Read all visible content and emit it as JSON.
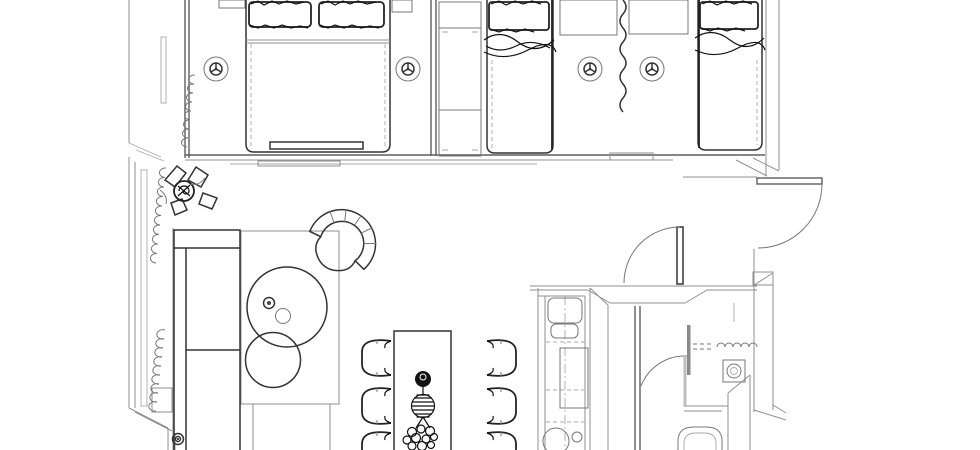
{
  "floor_plan": {
    "background": "#ffffff",
    "line_color": "#333333",
    "wall_color": "#8f8f8f",
    "accent_dark": "#111111",
    "rooms": [
      {
        "name": "master-bedroom",
        "aria": "Master bedroom: double bed with two pillows, two nightstands, foot bench, window curtain, sprinkler heads"
      },
      {
        "name": "second-bedroom",
        "aria": "Second bedroom: two single beds, wardrobe, two nightstands, curtain room divider, two sprinkler heads"
      },
      {
        "name": "living-room",
        "aria": "Living room: sofa, rug, two round coffee tables, curved armchair, potted plant, window curtains"
      },
      {
        "name": "dining-area",
        "aria": "Dining area: long table with six chairs and flower centerpiece"
      },
      {
        "name": "kitchen",
        "aria": "Kitchen: counter with cooktop, cabinet and round sink"
      },
      {
        "name": "bathroom",
        "aria": "Bathroom: glass shower screen, shower curtain, washing machine, toilet"
      },
      {
        "name": "entry-hall",
        "aria": "Entry hall: entrance door and interior door with swing arcs"
      }
    ],
    "symbols": {
      "sprinkler_positions": [
        [
          216,
          69
        ],
        [
          408,
          69
        ],
        [
          590,
          69
        ],
        [
          652,
          69
        ]
      ],
      "door_count": 3,
      "dining_chair_count": 6,
      "coffee_table_count": 2,
      "single_bed_count": 2,
      "double_bed_count": 1
    }
  }
}
